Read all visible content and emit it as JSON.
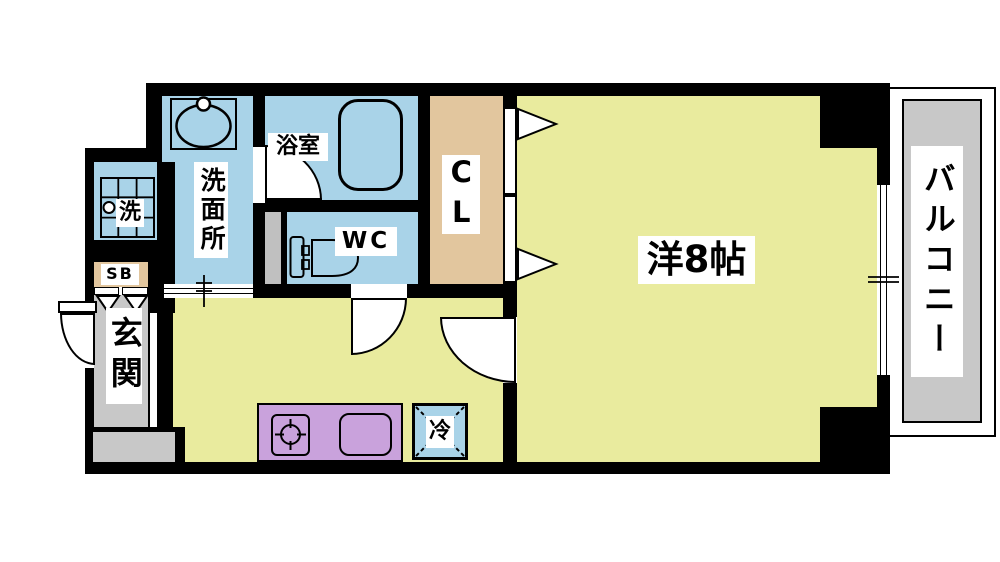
{
  "title": "1K apartment floor plan",
  "colors": {
    "wall_black": "#000000",
    "wet_area_blue": "#A9D3E8",
    "room_yellow": "#E9EB9E",
    "closet_beige": "#E2C69E",
    "kitchen_purple": "#C9A2DC",
    "concrete_gray": "#C8C8C8",
    "duct_gray": "#C0C0C0",
    "label_bg": "#FFFFFF"
  },
  "rooms": {
    "washroom": {
      "label": "洗面所"
    },
    "bathroom": {
      "label": "浴室"
    },
    "toilet": {
      "label": "WC"
    },
    "closet": {
      "label": "CL"
    },
    "western_room": {
      "label": "洋8帖"
    },
    "balcony": {
      "label": "バルコニー"
    },
    "entrance": {
      "label": "玄関"
    },
    "shoe_box": {
      "label": "SB"
    },
    "washer_space": {
      "label": "洗"
    },
    "refrigerator_space": {
      "label": "冷"
    }
  }
}
